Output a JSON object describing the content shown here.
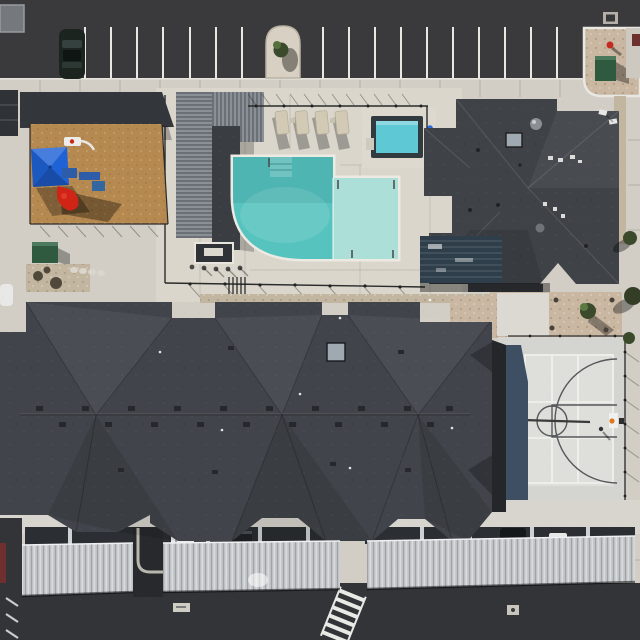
{
  "scene": {
    "type": "aerial-drone-photo",
    "title": "Overhead view of an apartment community amenity area",
    "no_visible_text": true
  },
  "features": {
    "parking_lot": "Asphalt parking lot with striped stalls and one parked dark car",
    "planter": "Arched stucco planter with small tree between parking stalls",
    "island": "Gravel curb island with green transformer box and red fire hydrant",
    "playground": "Playground with tan engineered mulch, blue shade sail, play structure, red slide and basketball toy",
    "pergola": "Slatted pergola and outdoor kitchen beside the pool deck",
    "pool": "L-shaped swimming pool with turquoise deep end and pale tanning ledge",
    "hot_tub": "Square spa / hot tub north-east of the pool",
    "loungers": "Row of four sun loungers on the pool deck",
    "clubhouse": "Clubhouse with dark hipped roof, skylight, vents and glass patio cover",
    "main_building": "Large apartment building with charcoal hipped roofs, ridge vents and a skylight",
    "basketball_court": "Half basketball court with white and grey markings, hoop on the east side",
    "carports": "Long light-grey corrugated carport canopies along the south drive",
    "crosswalk": "White ladder crosswalk on the south asphalt drive",
    "right_walk": "Concrete walkway and chain-link fence along the east edge with shrubs"
  },
  "colors": {
    "asphalt": "#3a3a3d",
    "asphalt_south": "#323438",
    "sidewalk": "#d2cec6",
    "deck": "#dad6cc",
    "deck_light": "#ded9cf",
    "parking_line": "#e9e7e2",
    "car_body": "#1c2420",
    "pool_main": "#57c3bf",
    "pool_ledge": "#abdfd8",
    "hot_tub_water": "#5ec9d5",
    "hot_tub_frame": "#303a3f",
    "mulch": "#b5894f",
    "canopy_blue": "#1f62d6",
    "slide_red": "#cf2416",
    "structure_blue": "#2d5da8",
    "roof_main": "#41444a",
    "roof_club": "#3f4247",
    "roof_shade": "#33363b",
    "carport": "#c6c9cc",
    "carport_band": "#2b2e32",
    "court": "#d4d5d1",
    "court_shadow": "#3e4f63",
    "court_line_white": "#f1f1ee",
    "court_line_dark": "#55575a",
    "gravel": "#c3b6a1",
    "island_gravel": "#c9b7a2",
    "utility_green": "#2f5a40",
    "hydrant_red": "#c32b20",
    "tree_green": "#3a4a2b",
    "pergola_slat": "#8a9096",
    "pergola_dark": "#3a3d41",
    "glass_patio": "#2e3e4a",
    "fence_dark": "#2b2b2b",
    "maroon": "#6e2f2f",
    "wall_light": "#d8d5cf",
    "white_car": "#e9eaea",
    "van_dark": "#1f2326",
    "skylight": "#9fa9b2"
  }
}
